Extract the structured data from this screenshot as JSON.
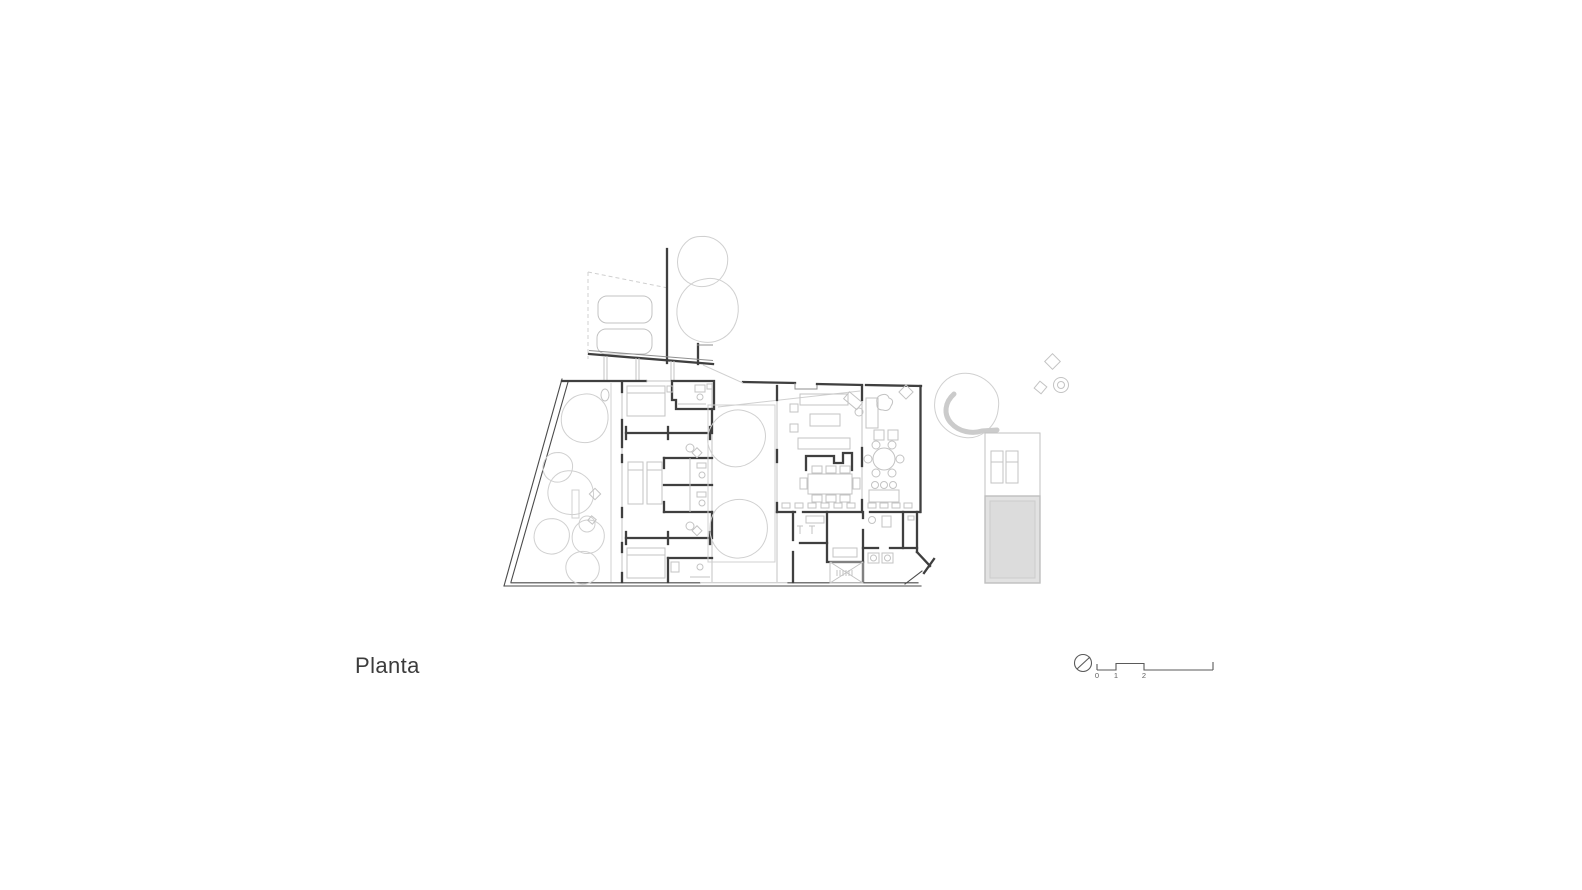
{
  "drawing": {
    "title": "Planta",
    "type": "architectural-floor-plan"
  },
  "scale_bar": {
    "labels": [
      "0",
      "1",
      "2",
      "5"
    ],
    "north_icon": "north-circle-icon"
  },
  "colors": {
    "background": "#ffffff",
    "wall_dark": "#3f3f3f",
    "line_medium": "#8f8f8f",
    "furniture_light": "#c3c3c3",
    "vegetation_faint": "#d0d0d0",
    "pool_fill": "#dcdcdc",
    "pool_frame": "#e2e2e2",
    "text": "#3c3c3c"
  }
}
